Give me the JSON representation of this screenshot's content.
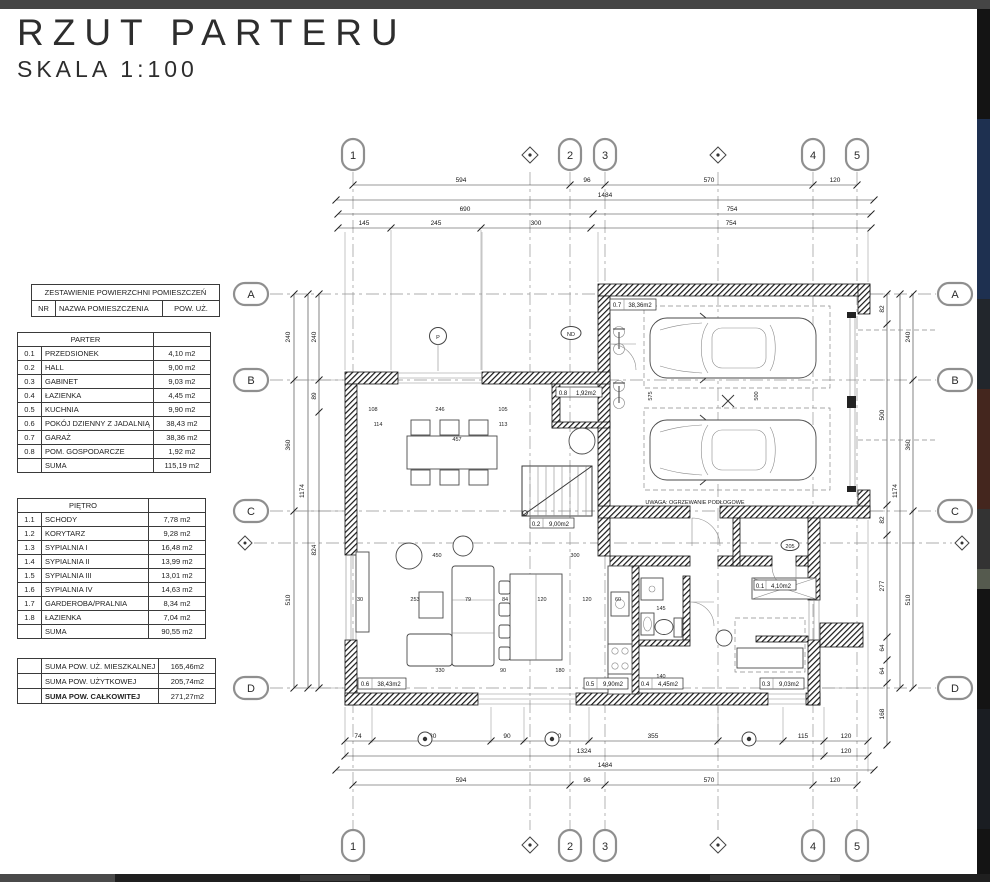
{
  "title": {
    "main": "RZUT PARTERU",
    "scale": "SKALA 1:100"
  },
  "area_table": {
    "title": "ZESTAWIENIE POWIERZCHNI POMIESZCZEŃ",
    "col_nr": "NR",
    "col_name": "NAZWA POMIESZCZENIA",
    "col_area": "POW. UŻ.",
    "parter": {
      "name": "PARTER",
      "rows": [
        [
          "0.1",
          "PRZEDSIONEK",
          "4,10 m2"
        ],
        [
          "0.2",
          "HALL",
          "9,00 m2"
        ],
        [
          "0.3",
          "GABINET",
          "9,03 m2"
        ],
        [
          "0.4",
          "ŁAZIENKA",
          "4,45 m2"
        ],
        [
          "0.5",
          "KUCHNIA",
          "9,90 m2"
        ],
        [
          "0.6",
          "POKÓJ DZIENNY Z JADALNIĄ",
          "38,43 m2"
        ],
        [
          "0.7",
          "GARAŻ",
          "38,36 m2"
        ],
        [
          "0.8",
          "POM. GOSPODARCZE",
          "1,92 m2"
        ]
      ],
      "suma_label": "SUMA",
      "suma_value": "115,19 m2"
    },
    "pietro": {
      "name": "PIĘTRO",
      "rows": [
        [
          "1.1",
          "SCHODY",
          "7,78 m2"
        ],
        [
          "1.2",
          "KORYTARZ",
          "9,28 m2"
        ],
        [
          "1.3",
          "SYPIALNIA I",
          "16,48 m2"
        ],
        [
          "1.4",
          "SYPIALNIA II",
          "13,99 m2"
        ],
        [
          "1.5",
          "SYPIALNIA III",
          "13,01 m2"
        ],
        [
          "1.6",
          "SYPIALNIA IV",
          "14,63 m2"
        ],
        [
          "1.7",
          "GARDEROBA/PRALNIA",
          "8,34 m2"
        ],
        [
          "1.8",
          "ŁAZIENKA",
          "7,04 m2"
        ]
      ],
      "suma_label": "SUMA",
      "suma_value": "90,55 m2"
    },
    "totals": [
      [
        "SUMA POW. UŻ. MIESZKALNEJ",
        "165,46m2"
      ],
      [
        "SUMA POW. UŻYTKOWEJ",
        "205,74m2"
      ],
      [
        "SUMA POW. CAŁKOWITEJ",
        "271,27m2"
      ]
    ]
  },
  "plan": {
    "grid_cols": [
      "1",
      "2",
      "3",
      "4",
      "5"
    ],
    "grid_rows": [
      "A",
      "B",
      "C",
      "D"
    ],
    "dims_top": {
      "r1": [
        "594",
        "96",
        "570",
        "120"
      ],
      "r2": [
        "1484"
      ],
      "r3": [
        "690",
        "754"
      ],
      "r4": [
        "145",
        "245",
        "300",
        "754"
      ]
    },
    "dims_bottom": {
      "r1": [
        "74",
        "330",
        "90",
        "180",
        "355",
        "180",
        "115",
        "120"
      ],
      "r2": [
        "1324",
        "120"
      ],
      "r3": [
        "1484"
      ],
      "r4": [
        "594",
        "96",
        "570",
        "120"
      ]
    },
    "dims_left": {
      "c1": [
        "240",
        "360",
        "510"
      ],
      "c2": [
        "1174"
      ],
      "c3": [
        "240",
        "89",
        "824"
      ]
    },
    "dims_right": {
      "c1": [
        "82",
        "500",
        "82",
        "277",
        "64",
        "64",
        "168"
      ],
      "c2": [
        "1174"
      ],
      "c3": [
        "240",
        "360",
        "510"
      ]
    },
    "interior_dims": [
      "108",
      "246",
      "105",
      "114",
      "113",
      "457",
      "450",
      "300",
      "30",
      "253",
      "79",
      "84",
      "120",
      "120",
      "60",
      "330",
      "90",
      "180",
      "575",
      "500",
      "145",
      "140"
    ],
    "room_labels": [
      {
        "nr": "0.7",
        "area": "38,36m2"
      },
      {
        "nr": "0.8",
        "area": "1,92m2"
      },
      {
        "nr": "0.2",
        "area": "9,00m2"
      },
      {
        "nr": "0.6",
        "area": "38,43m2"
      },
      {
        "nr": "0.5",
        "area": "9,90m2"
      },
      {
        "nr": "0.4",
        "area": "4,45m2"
      },
      {
        "nr": "0.3",
        "area": "9,03m2"
      },
      {
        "nr": "0.1",
        "area": "4,10m2"
      }
    ],
    "note": "UWAGA: OGRZEWANIE PODŁOGOWE",
    "markers": {
      "p": "P",
      "nd": "ND",
      "door_tag": "205"
    }
  }
}
